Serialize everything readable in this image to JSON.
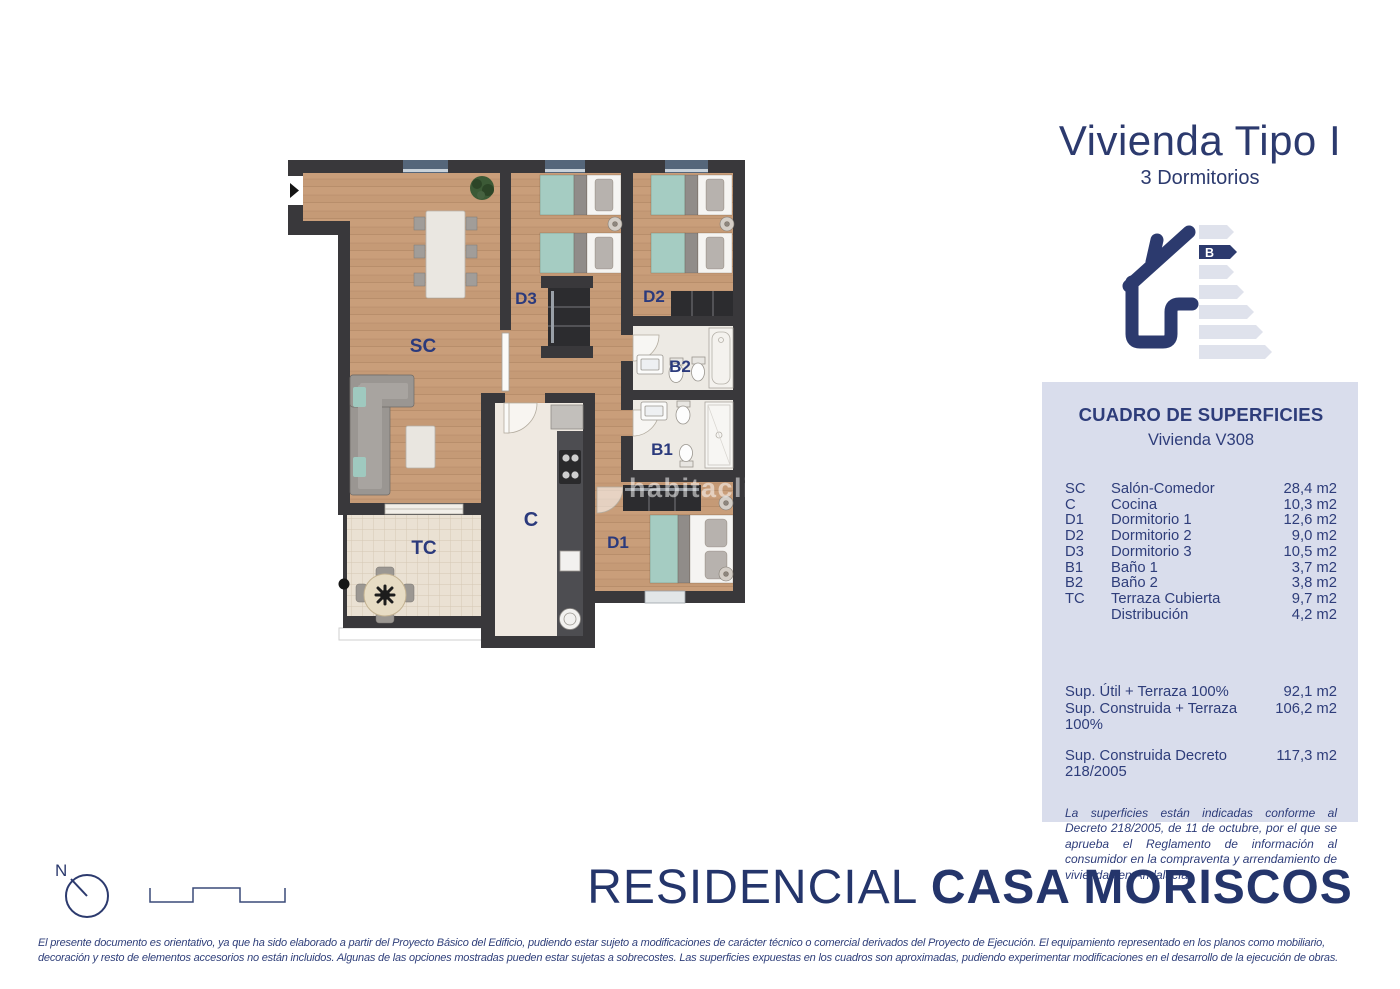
{
  "header": {
    "title": "Vivienda Tipo I",
    "subtitle": "3 Dormitorios"
  },
  "energy_label": {
    "rating": "B"
  },
  "surfaces_panel": {
    "title": "CUADRO DE SUPERFICIES",
    "subtitle": "Vivienda V308",
    "rows": [
      {
        "code": "SC",
        "name": "Salón-Comedor",
        "value": "28,4 m2"
      },
      {
        "code": "C",
        "name": "Cocina",
        "value": "10,3 m2"
      },
      {
        "code": "D1",
        "name": "Dormitorio 1",
        "value": "12,6 m2"
      },
      {
        "code": "D2",
        "name": "Dormitorio 2",
        "value": "9,0 m2"
      },
      {
        "code": "D3",
        "name": "Dormitorio 3",
        "value": "10,5 m2"
      },
      {
        "code": "B1",
        "name": "Baño 1",
        "value": "3,7 m2"
      },
      {
        "code": "B2",
        "name": "Baño 2",
        "value": "3,8 m2"
      },
      {
        "code": "TC",
        "name": "Terraza Cubierta",
        "value": "9,7 m2"
      },
      {
        "code": "",
        "name": "Distribución",
        "value": "4,2 m2"
      }
    ],
    "totals": [
      {
        "label": "Sup. Útil + Terraza 100%",
        "value": "92,1 m2"
      },
      {
        "label": "Sup. Construida + Terraza 100%",
        "value": "106,2 m2"
      }
    ],
    "total_decree": {
      "label": "Sup. Construida Decreto 218/2005",
      "value": "117,3 m2"
    },
    "note": "La superficies están indicadas conforme al Decreto 218/2005, de 11 de octubre, por el que se aprueba el Reglamento de información al consumidor en la compraventa y arrendamiento de viviendas en Andalucía."
  },
  "floor_plan": {
    "labels": {
      "sc": "SC",
      "d3": "D3",
      "d2": "D2",
      "b2": "B2",
      "b1": "B1",
      "c": "C",
      "d1": "D1",
      "tc": "TC"
    },
    "watermark": "habitaclia"
  },
  "footer": {
    "compass": "N",
    "brand_light": "RESIDENCIAL ",
    "brand_bold": "CASA MORISCOS",
    "disclaimer_line1": "El presente documento es orientativo, ya que ha sido elaborado a partir del Proyecto Básico del Edificio, pudiendo estar sujeto a modificaciones de carácter técnico o comercial derivados del Proyecto de Ejecución. El equipamiento representado en los planos como mobiliario,",
    "disclaimer_line2": "decoración y resto de elementos accesorios no están incluidos. Algunas de las opciones mostradas pueden estar sujetas a sobrecostes. Las superficies expuestas en los cuadros son aproximadas, pudiendo experimentar modificaciones en el desarrollo de la ejecución de obras."
  },
  "colors": {
    "navy": "#2c3a6e",
    "panel_bg": "#d9ddec",
    "wall": "#39383b",
    "wood": "#c59a76",
    "bed_teal": "#a5ccc2"
  }
}
